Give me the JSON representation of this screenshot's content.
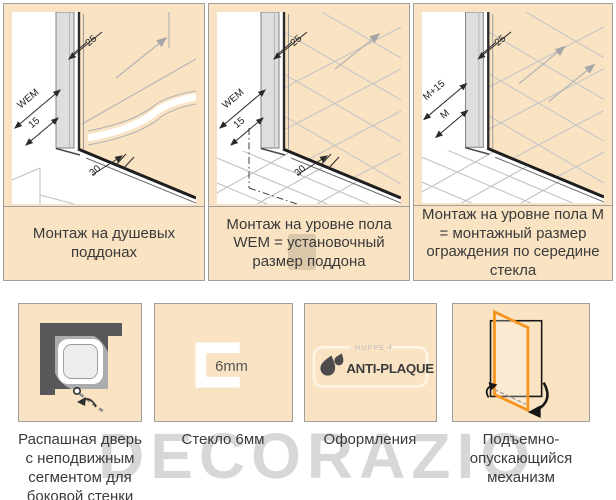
{
  "colors": {
    "panel_background": "#f9e3c2",
    "panel_border": "#9e9e9e",
    "caption_text": "#3a3a3a",
    "diagram_line_gray": "#b3b3b3",
    "diagram_line_dark": "#1e1e1e",
    "profile_gray": "#dedede",
    "icon_dark_gray": "#58585a",
    "icon_mid_gray": "#aaacae",
    "door_orange": "#f7941d",
    "watermark_gray": "#c9c9c9"
  },
  "top_row": {
    "panels": [
      {
        "caption": "Монтаж на душевых поддонах",
        "dim_25": "25",
        "dim_wem": "WEM",
        "dim_15": "15",
        "dim_30": "30"
      },
      {
        "caption": "Монтаж на уровне пола WEM = установочный размер поддона",
        "dim_25": "25",
        "dim_wem": "WEM",
        "dim_15": "15",
        "dim_30": "30"
      },
      {
        "caption": "Монтаж на уровне пола М = монтажный размер ограждения по середине стекла",
        "dim_25": "25",
        "dim_m_plus_15": "M+15",
        "dim_m": "M"
      }
    ]
  },
  "bottom_row": {
    "items": [
      {
        "caption": "Распашная дверь с неподвижным сегментом для боковой стенки"
      },
      {
        "caption": "Стекло 6мм",
        "glass_label": "6mm"
      },
      {
        "caption": "Оформления",
        "brand_label": "HUPPE",
        "logo_label": "ANTI-PLAQUE"
      },
      {
        "caption": "Подъемно-опускающийся механизм"
      }
    ]
  },
  "watermark": {
    "text": "DECORAZIO"
  }
}
